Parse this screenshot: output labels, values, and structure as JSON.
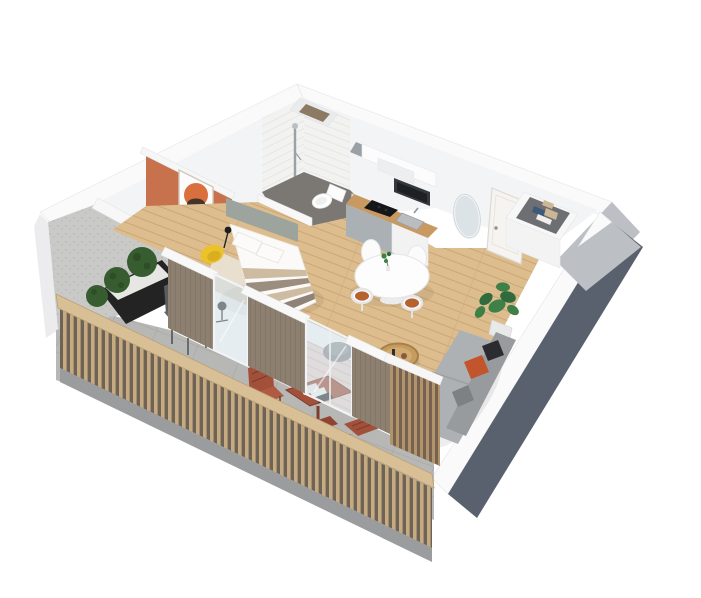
{
  "meta": {
    "title": "3D isometric floor plan — studio apartment with balcony",
    "view": "isometric cutaway render",
    "background": "#ffffff"
  },
  "scene": {
    "type": "3d-isometric-floor-plan",
    "rooms": [
      {
        "name": "bathroom",
        "items": [
          "walk-in tiled shower",
          "shower column",
          "toilet",
          "duct shaft",
          "vent opening",
          "white door ajar"
        ]
      },
      {
        "name": "kitchen",
        "items": [
          "upper cabinets",
          "extractor hood",
          "microwave oven",
          "wood countertop",
          "black cooktop",
          "steel sink",
          "steel appliance fronts"
        ]
      },
      {
        "name": "entry",
        "items": [
          "front door",
          "oval wall mirror",
          "open-top wardrobe with folded clothes"
        ]
      },
      {
        "name": "bedroom",
        "items": [
          "bed with striped duvet",
          "two pillows",
          "gray headboard",
          "terracotta accent wall",
          "framed abstract art",
          "yellow armchair",
          "black floor lamp",
          "desk chair",
          "pale rug"
        ]
      },
      {
        "name": "dining-area",
        "items": [
          "round white pedestal table",
          "four white tulip chairs",
          "cognac seat cushions",
          "small table plant"
        ]
      },
      {
        "name": "living-area",
        "items": [
          "gray sofa",
          "orange pillow",
          "dark pillow",
          "pink patterned rug",
          "rattan coffee table",
          "knitted pouf",
          "monstera plant"
        ]
      },
      {
        "name": "balcony",
        "items": [
          "concrete side wall",
          "black planter with three boxwood balls",
          "two gray folding chairs",
          "rust bistro table with papers",
          "rust bistro chair",
          "rust slatted bench",
          "wood slat railing",
          "wood privacy screen",
          "glass sliding door",
          "bedroom window",
          "gray tile floor"
        ]
      }
    ]
  },
  "colors": {
    "wall_top": "#fafafb",
    "wall_inner": "#f3f4f5",
    "wall_face_light": "#bcc0c5",
    "wall_face_dark": "#59616e",
    "outer_left": "#ececee",
    "accent_wall": "#c7714d",
    "concrete": "#c9c9c7",
    "speckle": "#b7b7b5",
    "wood_floor": "#ddbd8e",
    "plank_line": "#cba674",
    "bedroom_rug": "#e9dfcf",
    "bath_floor": "#7b7874",
    "tile": "#f2f2f0",
    "tile_line": "#e2e2e0",
    "counter_wood": "#c89a62",
    "cooktop": "#141619",
    "steel": "#aab0b4",
    "microwave": "#34383c",
    "cabinet": "#fcfcfd",
    "hood": "#eceeef",
    "door": "#f6f4f1",
    "mirror_glass": "#dbe3e7",
    "closet_hole": "#6e6f72",
    "clothes_navy": "#3f5a79",
    "clothes_beige": "#cbb793",
    "table_white": "#fdfdfe",
    "chair_cushion": "#b5622f",
    "plant_green": "#3f8048",
    "plant_dark": "#2f6b3c",
    "rug_pink": "#f0dcd8",
    "rug_stripe": "#e3c4bf",
    "pouf": "#8d9094",
    "coffee_table": "#c59c60",
    "sofa": "#aeb1b3",
    "sofa_back": "#989b9e",
    "pillow_orange": "#c2552b",
    "pillow_dark": "#2b2b30",
    "timber_wall": "#8d8070",
    "glass": "#cddbe1",
    "balcony_floor": "#b7b8b6",
    "balcony_line": "#a9aaa8",
    "planter": "#232323",
    "gravel": "#e6e6e3",
    "bush": "#375c30",
    "gray_chair": "#5a5c60",
    "bistro": "#a3503a",
    "bistro_dark": "#7e3c2b",
    "railing_wood": "#d8bf95",
    "railing_slat": "#c6aa80",
    "railing_shadow": "#6e6356",
    "railing_base": "#9a9c9e",
    "screen_slat": "#b2946c",
    "screen_shadow": "#776250",
    "yellow_chair": "#ecc22a",
    "headboard": "#9da39d",
    "bed_white": "#fbfaf8",
    "bed_stripe_a": "#cdbba2",
    "bed_stripe_b": "#9b8e7e",
    "bed_stripe_c": "#8e8376",
    "art_orange": "#d96f3d",
    "art_yellow": "#e5b33c",
    "art_brown": "#46332a",
    "toilet": "#ffffff"
  }
}
